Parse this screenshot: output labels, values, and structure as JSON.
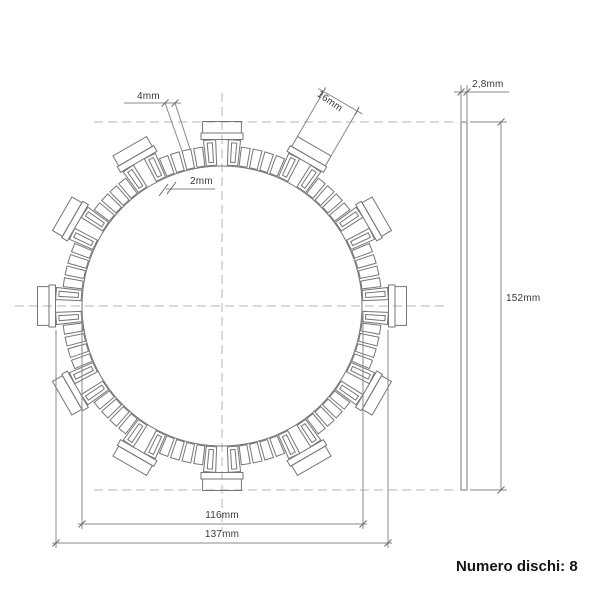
{
  "front_view": {
    "dim_tooth_width": "4mm",
    "dim_tooth_gap": "2mm",
    "dim_tab_width": "16mm",
    "dim_inner_diameter": "116mm",
    "dim_base_diameter": "137mm"
  },
  "side_view": {
    "dim_thickness": "2,8mm",
    "dim_outer_diameter": "152mm"
  },
  "footer": {
    "disc_count": "Numero dischi: 8"
  },
  "colors": {
    "geometry_line": "#757575",
    "dimension_line": "#8a8a8a",
    "centerline": "#b6b6b6",
    "tick": "#6a6a6a",
    "label_text": "#3a3a3a",
    "caption_text": "#141414",
    "background": "#ffffff"
  }
}
